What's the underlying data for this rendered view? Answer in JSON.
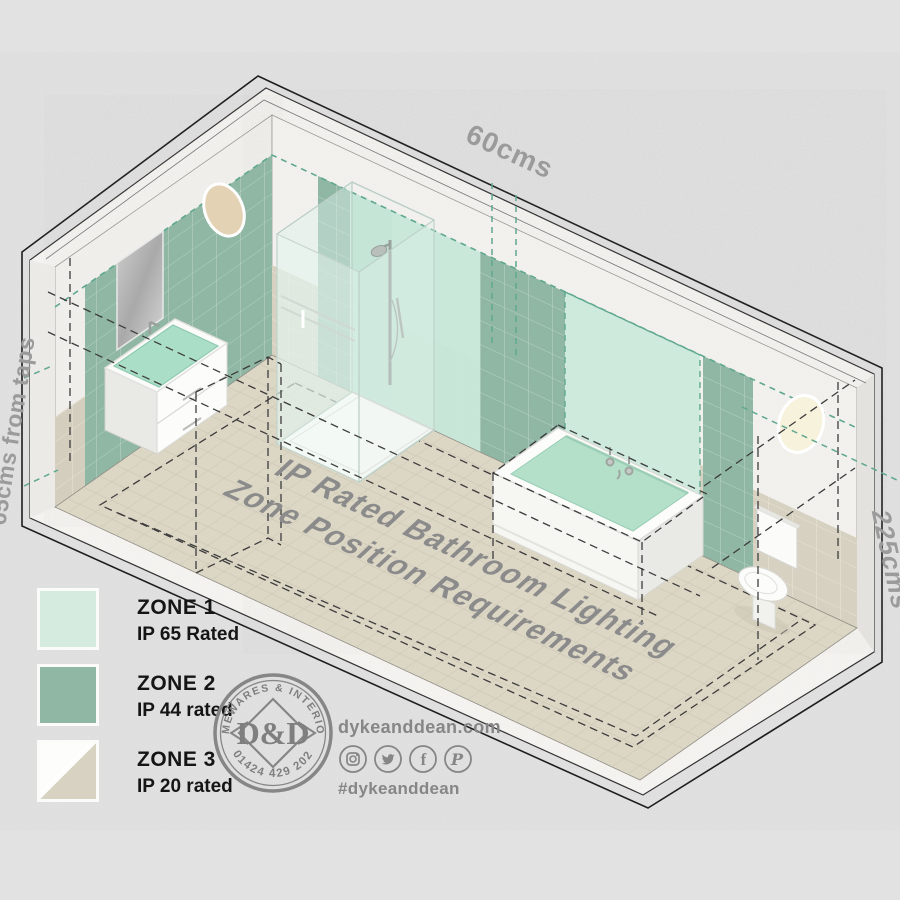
{
  "scene": {
    "dimensions": {
      "top": "60cms",
      "left": "65cms from taps",
      "right": "225cms"
    },
    "floor_title": {
      "line1": "IP Rated Bathroom Lighting",
      "line2": "Zone Position Requirements"
    }
  },
  "legend": {
    "zones": [
      {
        "label": "ZONE 1",
        "rating": "IP 65 Rated",
        "color": "#d5ebe0"
      },
      {
        "label": "ZONE 2",
        "rating": "IP 44 rated",
        "color": "#8fb7a4"
      },
      {
        "label": "ZONE 3",
        "rating": "IP 20 rated",
        "color_top": "#fdfdfb",
        "color_bottom": "#d8d2c3"
      }
    ]
  },
  "logo": {
    "arc_top": "HOMEWARES & INTERIORS",
    "monogram": "D&D",
    "arc_bottom": "01424 429 202"
  },
  "contact": {
    "website": "dykeanddean.com",
    "hashtag": "#dykeanddean",
    "social_icons": [
      "instagram-icon",
      "twitter-icon",
      "facebook-icon",
      "pinterest-icon"
    ]
  },
  "colors": {
    "background": "#e2e2e2",
    "zone1_mint": "#cdeadd",
    "zone2_green": "#8fb7a4",
    "zone3_beige": "#d8d2c3",
    "floor_tile": "#dcd6c5",
    "wall_tile": "#d7d1c1",
    "concrete": "#f4f3ef",
    "dashed_zone_line": "#3c3c3c",
    "dashed_measure_line": "#5fa88f",
    "dimension_label_gray": "#9b9b9b",
    "logo_gray": "#868686",
    "legend_text": "#151515"
  }
}
